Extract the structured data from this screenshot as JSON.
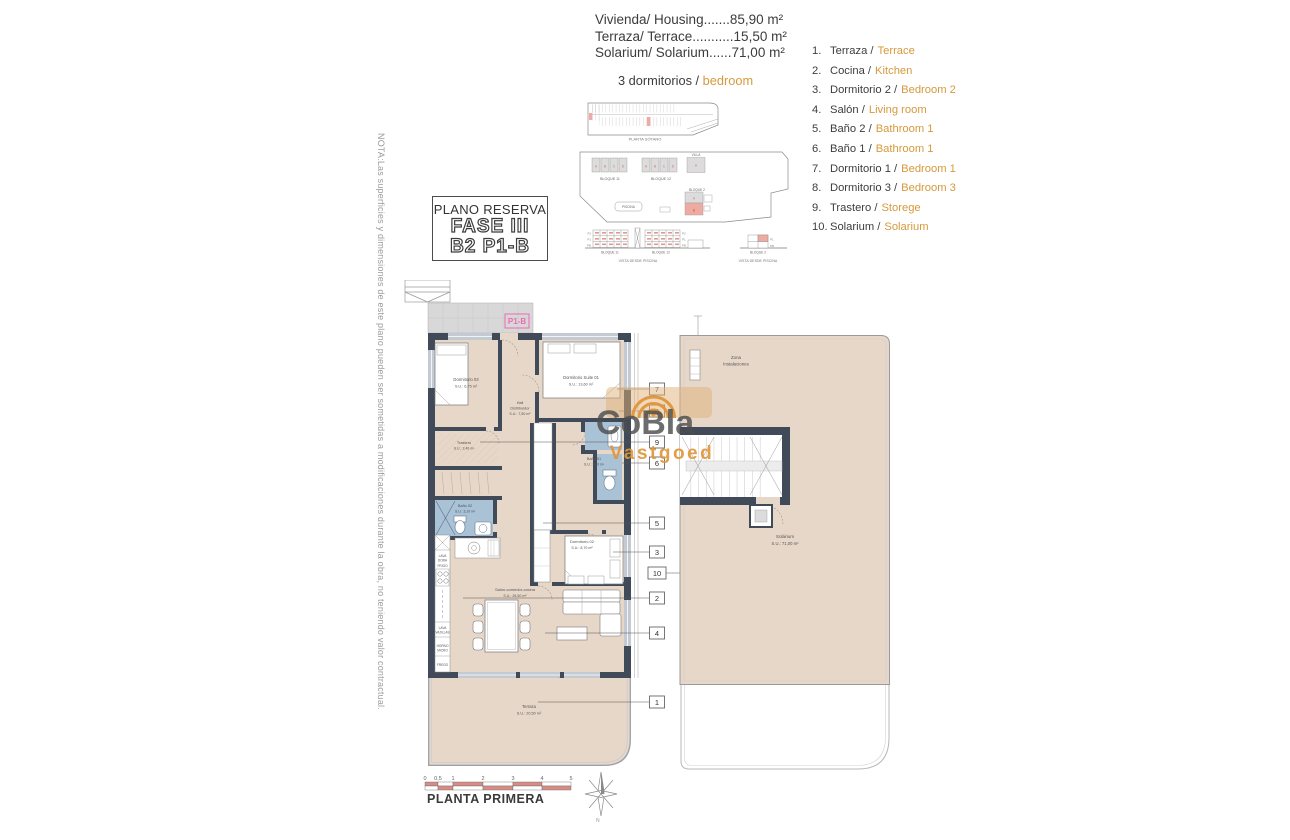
{
  "header": {
    "area_lines": [
      "Vivienda/ Housing.......85,90 m²",
      "Terraza/ Terrace...........15,50 m²",
      "Solarium/ Solarium......71,00 m²"
    ],
    "bedrooms_es": "3 dormitorios /",
    "bedrooms_en": "bedroom"
  },
  "legend": {
    "items": [
      {
        "n": "1.",
        "es": "Terraza /",
        "en": "Terrace"
      },
      {
        "n": "2.",
        "es": "Cocina /",
        "en": "Kitchen"
      },
      {
        "n": "3.",
        "es": "Dormitorio 2 /",
        "en": "Bedroom 2"
      },
      {
        "n": "4.",
        "es": "Salón /",
        "en": "Living room"
      },
      {
        "n": "5.",
        "es": "Baño 2 /",
        "en": "Bathroom 1"
      },
      {
        "n": "6.",
        "es": "Baño 1 /",
        "en": "Bathroom 1"
      },
      {
        "n": "7.",
        "es": "Dormitorio 1 /",
        "en": "Bedroom 1"
      },
      {
        "n": "8.",
        "es": "Dormitorio 3 /",
        "en": "Bedroom 3"
      },
      {
        "n": "9.",
        "es": "Trastero /",
        "en": "Storege"
      },
      {
        "n": "10.",
        "es": "Solarium /",
        "en": "Solarium"
      }
    ]
  },
  "title_block": {
    "title": "PLANO RESERVA",
    "fase": "FASE III",
    "unit": "B2 P1-B"
  },
  "note": "NOTA:Las superficies y dimensiones de este plano pueden ser sometidas a modificaciones durante la obra, no teniendo valor contractual.",
  "site": {
    "basement_caption": "PLANTA SÓTANO",
    "bloque11": "BLOQUE 11",
    "bloque12": "BLOQUE 12",
    "bloque2": "BLOQUE 2",
    "villa": "VILLA",
    "piscina": "PISCINA",
    "vista": "VISTA DESDE PISCINA",
    "floors": [
      "P2",
      "P1",
      "PB"
    ],
    "units": [
      "A",
      "B",
      "C",
      "D"
    ]
  },
  "plan": {
    "unit_tag": "P1-B",
    "dorm3_name": "Dormitorio 03",
    "dorm3_area": "S.U.: 6,75 m²",
    "suite_name": "Dormitorio Suite 01",
    "suite_area": "S.U.: 13,60 m²",
    "hall_l1": "Hall",
    "hall_l2": "Distribuidor",
    "hall_area": "S.U.: 7,50 m²",
    "trastero_name": "Trastero",
    "trastero_area": "S.U.: 2,40 m²",
    "bano1_name": "Baño 01",
    "bano1_area": "S.U.: 3,60 m²",
    "bano2_name": "Baño 02",
    "bano2_area": "S.U.: 3,10 m²",
    "dorm2_name": "Dormitorio 02",
    "dorm2_area": "S.U.: 8,70 m²",
    "salon_name": "Salón-comedor-cocina",
    "salon_area": "S.U.: 26,50 m²",
    "terraza_name": "Terraza",
    "terraza_area": "S.U.: 20,50 m²",
    "kitchen": [
      [
        "LAVA",
        "DORA"
      ],
      [
        "FRIGO"
      ],
      [
        "LAVA",
        "VAJILLAS"
      ],
      [
        "HORNO",
        "MICRO"
      ],
      [
        "FREGO"
      ]
    ],
    "callouts": [
      "7",
      "8",
      "9",
      "6",
      "5",
      "3",
      "10",
      "2",
      "4",
      "1"
    ]
  },
  "solarium": {
    "zona1": "Zona",
    "zona2": "Instalaciones",
    "name": "Solárium",
    "area": "S.U.: 71,00 m²"
  },
  "watermark": {
    "brand": "CoBla",
    "sub": "Vastgoed"
  },
  "footer": {
    "scale_ticks": [
      "0",
      "0,5",
      "1",
      "2",
      "3",
      "4",
      "5"
    ],
    "caption": "PLANTA PRIMERA",
    "compass": "N"
  },
  "colors": {
    "accent_orange": "#d6993c",
    "wall": "#414a59",
    "floor": "#e7d7c8",
    "bath_blue": "#a9c2d6",
    "red_highlight": "#efaaa2",
    "magenta": "#ee6ab5",
    "scale_red": "#d98c85"
  }
}
